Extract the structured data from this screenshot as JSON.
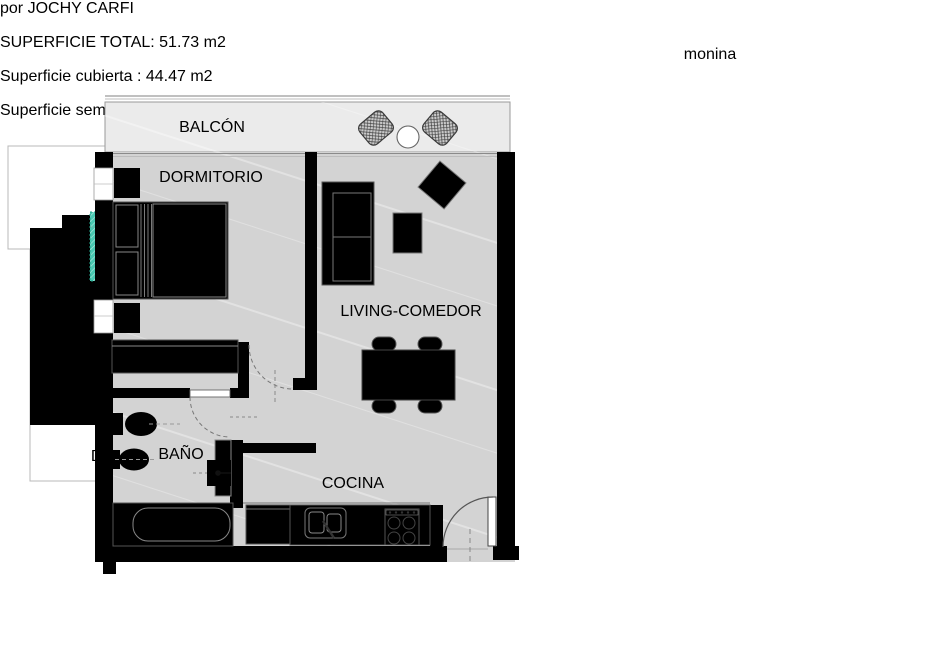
{
  "header": {
    "title": "monina",
    "subtitle": "por JOCHY CARFI"
  },
  "surfaces": {
    "total": "SUPERFICIE TOTAL: 51.73 m2",
    "covered": "Superficie cubierta : 44.47 m2",
    "semi_covered": "Superficie semi- cubierta : 7.26 m2"
  },
  "floorplan": {
    "labels": {
      "balcony": "BALCÓN",
      "bedroom": "DORMITORIO",
      "living": "LIVING-COMEDOR",
      "bathroom": "BAÑO",
      "kitchen": "COCINA"
    }
  },
  "locator": {
    "unit_label": "Dpto. X5"
  },
  "colors": {
    "wall_teal": "#12a78c",
    "unit_highlight": "#45c7b1",
    "subtitle_red": "#a33d48",
    "unit_label_red": "#8c2127"
  }
}
